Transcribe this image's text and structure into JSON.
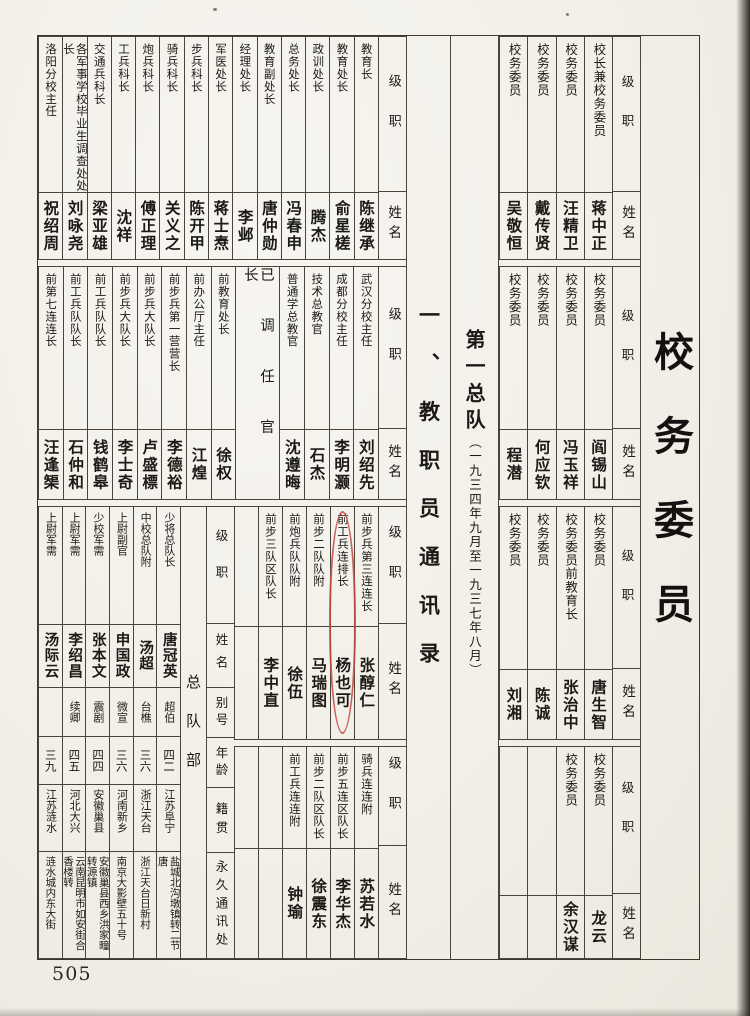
{
  "page": {
    "number": "505"
  },
  "titles": {
    "section": "校务委员",
    "list": "一、教职员通讯录",
    "unit_main": "第一总队",
    "unit_dates": "（一九三四年九月至一九三七年八月）"
  },
  "headers": {
    "rank": "级职",
    "name": "姓名",
    "alias": "别号",
    "age": "年龄",
    "origin": "籍贯",
    "address": "永久通讯处"
  },
  "committee_bands": [
    {
      "entries": [
        {
          "rank": "校长兼校务委员",
          "name": "蒋中正"
        },
        {
          "rank": "校务委员",
          "name": "汪精卫"
        },
        {
          "rank": "校务委员",
          "name": "戴传贤"
        },
        {
          "rank": "校务委员",
          "name": "吴敬恒"
        }
      ]
    },
    {
      "entries": [
        {
          "rank": "校务委员",
          "name": "阎锡山"
        },
        {
          "rank": "校务委员",
          "name": "冯玉祥"
        },
        {
          "rank": "校务委员",
          "name": "何应钦"
        },
        {
          "rank": "校务委员",
          "name": "程潜"
        }
      ]
    },
    {
      "entries": [
        {
          "rank": "校务委员",
          "name": "唐生智"
        },
        {
          "rank": "校务委员前教育长",
          "name": "张治中"
        },
        {
          "rank": "校务委员",
          "name": "陈诚"
        },
        {
          "rank": "校务委员",
          "name": "刘湘"
        }
      ]
    },
    {
      "entries": [
        {
          "rank": "校务委员",
          "name": "龙云"
        },
        {
          "rank": "校务委员",
          "name": "余汉谋"
        },
        {
          "rank": "",
          "name": ""
        },
        {
          "rank": "",
          "name": ""
        }
      ]
    }
  ],
  "staff_band1": [
    {
      "rank": "教育长",
      "name": "陈继承"
    },
    {
      "rank": "教育处长",
      "name": "俞星槎"
    },
    {
      "rank": "政训处长",
      "name": "腾杰"
    },
    {
      "rank": "总务处长",
      "name": "冯春申"
    },
    {
      "rank": "教育副处长",
      "name": "唐仲勋"
    },
    {
      "rank": "经理处长",
      "name": "李邺"
    },
    {
      "rank": "军医处长",
      "name": "蒋士焘"
    },
    {
      "rank": "步兵科长",
      "name": "陈开甲"
    },
    {
      "rank": "骑兵科长",
      "name": "关义之"
    },
    {
      "rank": "炮兵科长",
      "name": "傅正理"
    },
    {
      "rank": "工兵科长",
      "name": "沈祥"
    },
    {
      "rank": "交通兵科长",
      "name": "梁亚雄"
    },
    {
      "rank": "各军事学校毕业生调查处处长",
      "name": "刘咏尧"
    },
    {
      "rank": "洛阳分校主任",
      "name": "祝绍周"
    }
  ],
  "section_label": "已调任官长",
  "staff_band2a": [
    {
      "rank": "武汉分校主任",
      "name": "刘绍先"
    },
    {
      "rank": "成都分校主任",
      "name": "李明灏"
    },
    {
      "rank": "技术总教官",
      "name": "石杰"
    },
    {
      "rank": "普通学总教官",
      "name": "沈遵晦"
    }
  ],
  "staff_band2b": [
    {
      "rank": "前教育处长",
      "name": "徐权"
    },
    {
      "rank": "前办公厅主任",
      "name": "江煌"
    },
    {
      "rank": "前步兵第一营营长",
      "name": "李德裕"
    },
    {
      "rank": "前步兵大队长",
      "name": "卢盛標"
    },
    {
      "rank": "前步兵大队长",
      "name": "李士奇"
    },
    {
      "rank": "前工兵队队长",
      "name": "钱鹤皋"
    },
    {
      "rank": "前工兵队队长",
      "name": "石仲和"
    },
    {
      "rank": "前第七连连长",
      "name": "汪逢榘"
    }
  ],
  "staff_band3": [
    {
      "rank": "前步兵第三连连长",
      "name": "张醇仁"
    },
    {
      "rank": "前工兵连排长",
      "name": "杨也可"
    },
    {
      "rank": "前步二队队附",
      "name": "马瑞图"
    },
    {
      "rank": "前炮兵队队附",
      "name": "徐伍"
    },
    {
      "rank": "前步三队区队长",
      "name": "李中直"
    },
    {
      "rank": "",
      "name": ""
    }
  ],
  "staff_band4": [
    {
      "rank": "骑兵连连附",
      "name": "苏若水"
    },
    {
      "rank": "前步五连区队长",
      "name": "李华杰"
    },
    {
      "rank": "前步二队区队长",
      "name": "徐震东"
    },
    {
      "rank": "前工兵连连附",
      "name": "钟瑜"
    },
    {
      "rank": "",
      "name": ""
    },
    {
      "rank": "",
      "name": ""
    }
  ],
  "hq": {
    "label": "总队部",
    "members": [
      {
        "rank": "少将总队长",
        "name": "唐冠英",
        "alias": "超伯",
        "age": "四二",
        "origin": "江苏阜宁",
        "address": "盐城北沟墩镇转二节唐"
      },
      {
        "rank": "中校总队附",
        "name": "汤超",
        "alias": "台樵",
        "age": "三六",
        "origin": "浙江天台",
        "address": "浙江天台日新村"
      },
      {
        "rank": "上尉副官",
        "name": "申国政",
        "alias": "微宣",
        "age": "三六",
        "origin": "河南新乡",
        "address": "南京大影壁五十号"
      },
      {
        "rank": "少校军需",
        "name": "张本文",
        "alias": "震剧",
        "age": "四四",
        "origin": "安徽巢县",
        "address": "安徽巢县西乡洪家疃转源镇"
      },
      {
        "rank": "上尉军需",
        "name": "李绍昌",
        "alias": "续卿",
        "age": "四五",
        "origin": "河北大兴",
        "address": "云南昆明市如安街合香楼转"
      },
      {
        "rank": "上尉军需",
        "name": "汤际云",
        "alias": "",
        "age": "三九",
        "origin": "江苏涟水",
        "address": "涟水城内东大街"
      }
    ]
  },
  "annotation": {
    "type": "red-oval",
    "around": "杨也可",
    "color": "#c5473f"
  }
}
